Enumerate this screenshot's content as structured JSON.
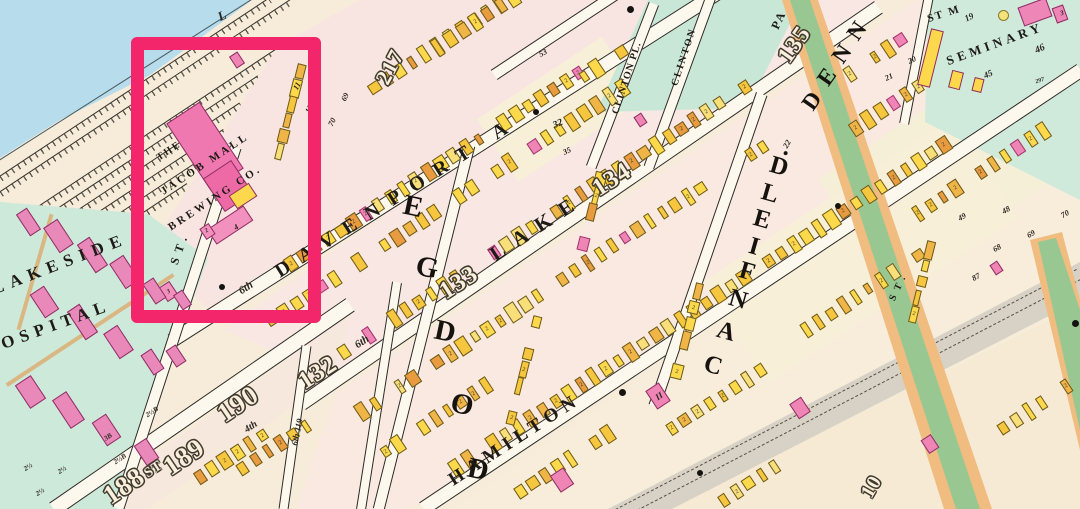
{
  "map": {
    "highlight_color": "#f3256b",
    "landmark": {
      "line1": "THE",
      "line2": "JACOB MALL",
      "line3": "BREWING CO."
    },
    "texts": {
      "davenport": "DAVENPORT A",
      "davenport_prefix": "6th",
      "lake": "LAKE",
      "hamilton": "HAMILTON",
      "clinton_pl": "CLINTON PL.",
      "clinton": "CLINTON",
      "st_c1": "ST.",
      "st_denn": "ST.",
      "sixth_119": "6th 119",
      "fourth": "4th",
      "sixth_132": "6th",
      "l_partial": "L",
      "lakeside": "LAKESIDE",
      "hospital": "HOSPITAL",
      "st_m": "ST M",
      "seminary": "SEMINARY",
      "park_partial": "PA",
      "n217": "217",
      "n135": "135",
      "n134": "134",
      "n133": "133",
      "n132": "132",
      "n190": "190",
      "n189": "189",
      "n_st": "ST",
      "n188": "188",
      "n10": "10"
    },
    "words": {
      "dodge": "DODGE",
      "canfield": "CANFIELD.",
      "denn": "DENN"
    },
    "annotations": [
      {
        "id": "a69",
        "text": "69"
      },
      {
        "id": "a70",
        "text": "70"
      },
      {
        "id": "a13",
        "text": "13"
      },
      {
        "id": "a11",
        "text": "11"
      },
      {
        "id": "a53",
        "text": "53"
      },
      {
        "id": "a32",
        "text": "32"
      },
      {
        "id": "a35",
        "text": "35"
      },
      {
        "id": "a48",
        "text": "48"
      },
      {
        "id": "a49",
        "text": "49"
      },
      {
        "id": "a68",
        "text": "68"
      },
      {
        "id": "a69b",
        "text": "69"
      },
      {
        "id": "a70b",
        "text": "70"
      },
      {
        "id": "a87",
        "text": "87"
      },
      {
        "id": "a20",
        "text": "20"
      },
      {
        "id": "a21",
        "text": "21"
      },
      {
        "id": "a19",
        "text": "19"
      },
      {
        "id": "a46",
        "text": "46"
      },
      {
        "id": "a45",
        "text": "45"
      },
      {
        "id": "a297",
        "text": "297"
      },
      {
        "id": "a22",
        "text": "22"
      },
      {
        "id": "b4",
        "text": "4"
      },
      {
        "id": "b2",
        "text": "2"
      },
      {
        "id": "b3",
        "text": "3"
      },
      {
        "id": "h2a",
        "text": "2½"
      },
      {
        "id": "h2b",
        "text": "2½"
      },
      {
        "id": "h2c",
        "text": "2½"
      },
      {
        "id": "h3B",
        "text": "3B"
      },
      {
        "id": "hB1",
        "text": "2½B"
      },
      {
        "id": "hB2",
        "text": "2½B"
      },
      {
        "id": "ii",
        "text": "II"
      },
      {
        "id": "sem3",
        "text": "3"
      }
    ],
    "houses": {
      "default_label": "2",
      "palette": [
        "#fcd84b",
        "#fcd84b",
        "#fcd84b",
        "#f6c73e",
        "#f6c73e",
        "#f0b547",
        "#e89b3f",
        "#f8df7a"
      ],
      "pink": "#ee85b5"
    },
    "colors": {
      "water": "#b7dcec",
      "teal": "#cde9da",
      "park": "#c9e7d6",
      "gray_road": "#d8d2c6",
      "boulevard_green": "#98c791",
      "boulevard_orange": "#f0bc80",
      "block_pink": "#f8e5e1",
      "block_cream": "#f8ecdb",
      "landmark_pink": "#f078b0"
    }
  }
}
